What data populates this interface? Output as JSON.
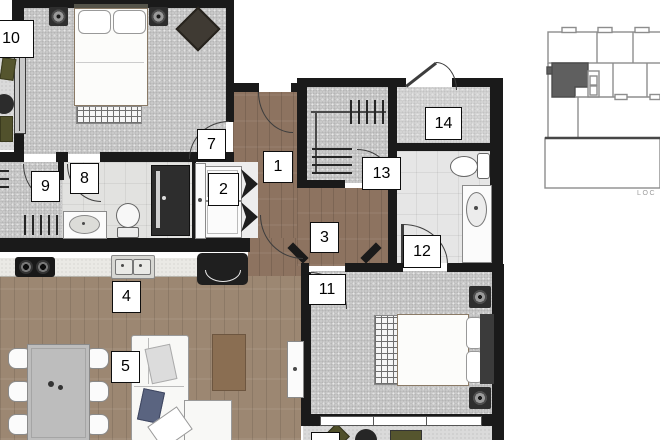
{
  "floor_plan": {
    "room_labels": {
      "r1": "1",
      "r2": "2",
      "r3": "3",
      "r4": "4",
      "r5": "5",
      "r7": "7",
      "r8": "8",
      "r9": "9",
      "r10": "10",
      "r11": "11",
      "r12": "12",
      "r13": "13",
      "r14": "14"
    },
    "partial_label": "",
    "key_map": {
      "caption": "LOC"
    },
    "colors": {
      "wall": "#1a1a1a",
      "hallway_wood": "#8d7360",
      "living_wood": "#9c8772",
      "carpet_gray": "#c9c9c9",
      "tile": "#e6e6e6",
      "balcony": "#dadada",
      "counter": "#eae9e5",
      "rug_tan": "#8a6e52",
      "pillow_navy": "#5a6480",
      "plant_olive": "#55552e",
      "keymap_stroke": "#8d8d8d",
      "keymap_highlight": "#5f5f5f"
    },
    "icons": [
      "bed-icon",
      "pillow-icon",
      "speaker-icon",
      "armchair-icon",
      "rug-icon",
      "sliding-door-icon",
      "door-arc-icon",
      "sink-icon",
      "toilet-icon",
      "shower-icon",
      "vanity-icon",
      "washer-icon",
      "bifold-door-icon",
      "cooktop-icon",
      "kitchen-sink-icon",
      "bench-icon",
      "dining-table-icon",
      "chair-icon",
      "sofa-icon",
      "coffee-table-icon",
      "tv-cabinet-icon",
      "closet-rod-icon",
      "plant-icon",
      "balcony-table-icon",
      "window-icon",
      "key-map-icon"
    ]
  }
}
